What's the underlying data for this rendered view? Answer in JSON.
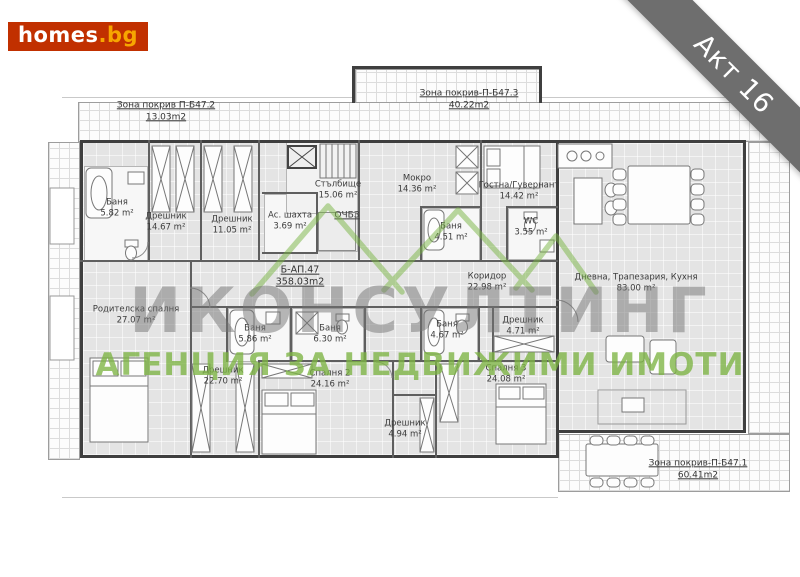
{
  "branding": {
    "logo_text": "homes",
    "logo_suffix": ".bg",
    "brand_red": "#c13000",
    "brand_orange": "#f7a600"
  },
  "ribbon": {
    "label": "Акт 16",
    "color": "#6e6e6e"
  },
  "watermark": {
    "line1": "ИКОНСУЛТИНГ",
    "line2": "АГЕНЦИЯ ЗА НЕДВИЖИМИ ИМОТИ",
    "green": "#7cb342",
    "gray": "#737373"
  },
  "plan": {
    "apartment_label": {
      "name": "Б-АП.47",
      "area": "358.03m2"
    },
    "zones": [
      {
        "name": "Зона покрив П-Б47.2",
        "area": "13.03m2",
        "x": 166,
        "y": 112
      },
      {
        "name": "Зона покрив-П-Б47.3",
        "area": "40.22m2",
        "x": 469,
        "y": 100
      },
      {
        "name": "Зона покрив-П-Б47.1",
        "area": "60.41m2",
        "x": 698,
        "y": 470
      }
    ],
    "rooms": [
      {
        "name": "Баня",
        "area": "5.82 m²",
        "x": 117,
        "y": 208
      },
      {
        "name": "Дрешник",
        "area": "14.67 m²",
        "x": 166,
        "y": 222
      },
      {
        "name": "Дрешник",
        "area": "11.05 m²",
        "x": 232,
        "y": 225
      },
      {
        "name": "Ас. шахта",
        "area": "3.69 m²",
        "x": 290,
        "y": 221
      },
      {
        "name": "Стълбище",
        "area": "15.06 m²",
        "x": 338,
        "y": 190
      },
      {
        "name": "ОЧБЗ",
        "area": "",
        "x": 347,
        "y": 216,
        "underline": true
      },
      {
        "name": "Мокро",
        "area": "14.36 m²",
        "x": 417,
        "y": 184
      },
      {
        "name": "Баня",
        "area": "4.51 m²",
        "x": 451,
        "y": 232
      },
      {
        "name": "Гостна/Гувернант",
        "area": "14.42 m²",
        "x": 519,
        "y": 191
      },
      {
        "name": "WC",
        "area": "3.55 m²",
        "x": 531,
        "y": 227
      },
      {
        "name": "Коридор",
        "area": "22.98 m²",
        "x": 487,
        "y": 282
      },
      {
        "name": "Дневна, Трапезария, Кухня",
        "area": "83.00 m²",
        "x": 636,
        "y": 283
      },
      {
        "name": "Родителска спалня",
        "area": "27.07 m²",
        "x": 136,
        "y": 315
      },
      {
        "name": "Баня",
        "area": "5.86 m²",
        "x": 255,
        "y": 334
      },
      {
        "name": "Баня",
        "area": "6.30 m²",
        "x": 330,
        "y": 334
      },
      {
        "name": "Дрешник",
        "area": "22.70 m²",
        "x": 223,
        "y": 376
      },
      {
        "name": "Спалня 2",
        "area": "24.16 m²",
        "x": 330,
        "y": 379
      },
      {
        "name": "Баня",
        "area": "4.67 m²",
        "x": 447,
        "y": 330
      },
      {
        "name": "Дрешник",
        "area": "4.71 m²",
        "x": 523,
        "y": 326
      },
      {
        "name": "Дрешник",
        "area": "4.94 m²",
        "x": 405,
        "y": 429
      },
      {
        "name": "Спалня 3",
        "area": "24.08 m²",
        "x": 506,
        "y": 374
      }
    ]
  }
}
